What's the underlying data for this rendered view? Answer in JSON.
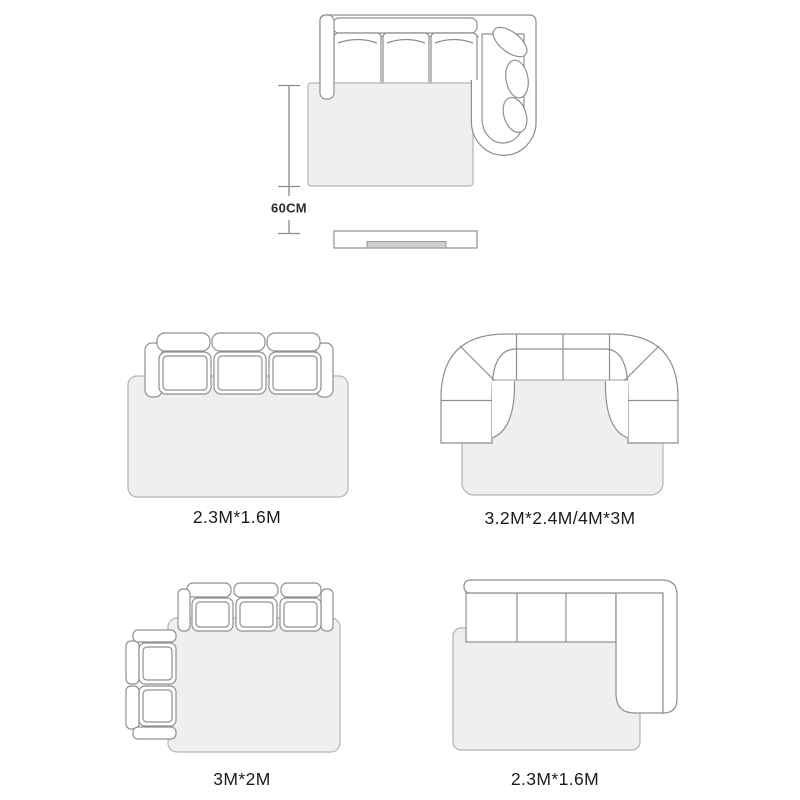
{
  "colors": {
    "background": "#ffffff",
    "furniture_line": "#8f8f8f",
    "rug_fill": "#f1efed",
    "rug_line": "#b7b2ae",
    "dimension_line": "#8c8c8c",
    "tv_fill": "#cdcdcd",
    "text": "#1b1b1b"
  },
  "top_diagram": {
    "name": "corner-sofa-with-chaise-rug-and-tv-stand",
    "dimension_label": "60CM"
  },
  "size_cards": [
    {
      "name": "three-seat-sofa-with-rug",
      "size_label": "2.3M*1.6M"
    },
    {
      "name": "curved-sectional-sofa-with-rug",
      "size_label": "3.2M*2.4M/4M*3M"
    },
    {
      "name": "three-seat-sofa-with-side-loveseat-and-rug",
      "size_label": "3M*2M"
    },
    {
      "name": "l-shaped-sectional-sofa-with-rug",
      "size_label": "2.3M*1.6M"
    }
  ]
}
